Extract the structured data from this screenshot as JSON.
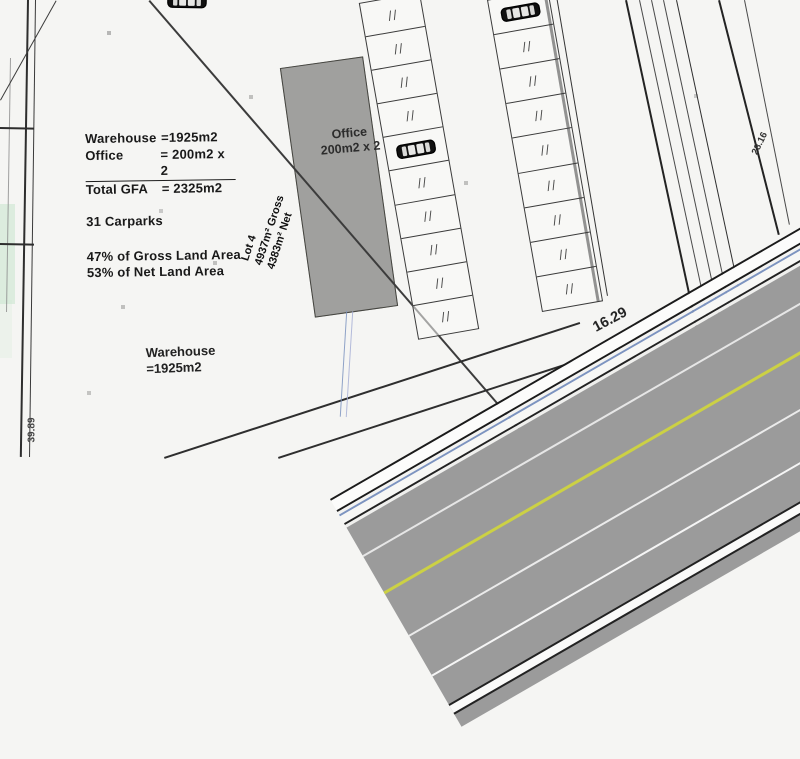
{
  "plan": {
    "gfa_table": {
      "rows": [
        {
          "label": "Warehouse",
          "value": "=1925m2"
        },
        {
          "label": "Office",
          "value": "= 200m2 x 2"
        },
        {
          "label": "Total GFA",
          "value": "= 2325m2"
        }
      ],
      "carparks_note": "31 Carparks",
      "gross_note": "47% of Gross Land Area",
      "net_note": "53% of Net Land Area"
    },
    "labels": {
      "office_building": {
        "line1": "Office",
        "line2": "200m2 x 2"
      },
      "warehouse": {
        "line1": "Warehouse",
        "line2": "=1925m2"
      },
      "lot": {
        "line1": "Lot 4",
        "line2": "4937m² Gross",
        "line3": "4383m² Net"
      },
      "dim_road": "16.29",
      "dim_right": "28.16",
      "dim_left": "39.89"
    },
    "parking": {
      "column1": {
        "stalls": 10,
        "car_stall": 5
      },
      "column2": {
        "stalls": 9,
        "car_stall": 1
      }
    },
    "colors": {
      "building_fill": "#a0a09e",
      "road_surface": "#9b9b9b",
      "lane_yellow": "#ccd144",
      "kerb_blue": "#7d94c0",
      "ink": "#1c1c1c"
    }
  }
}
